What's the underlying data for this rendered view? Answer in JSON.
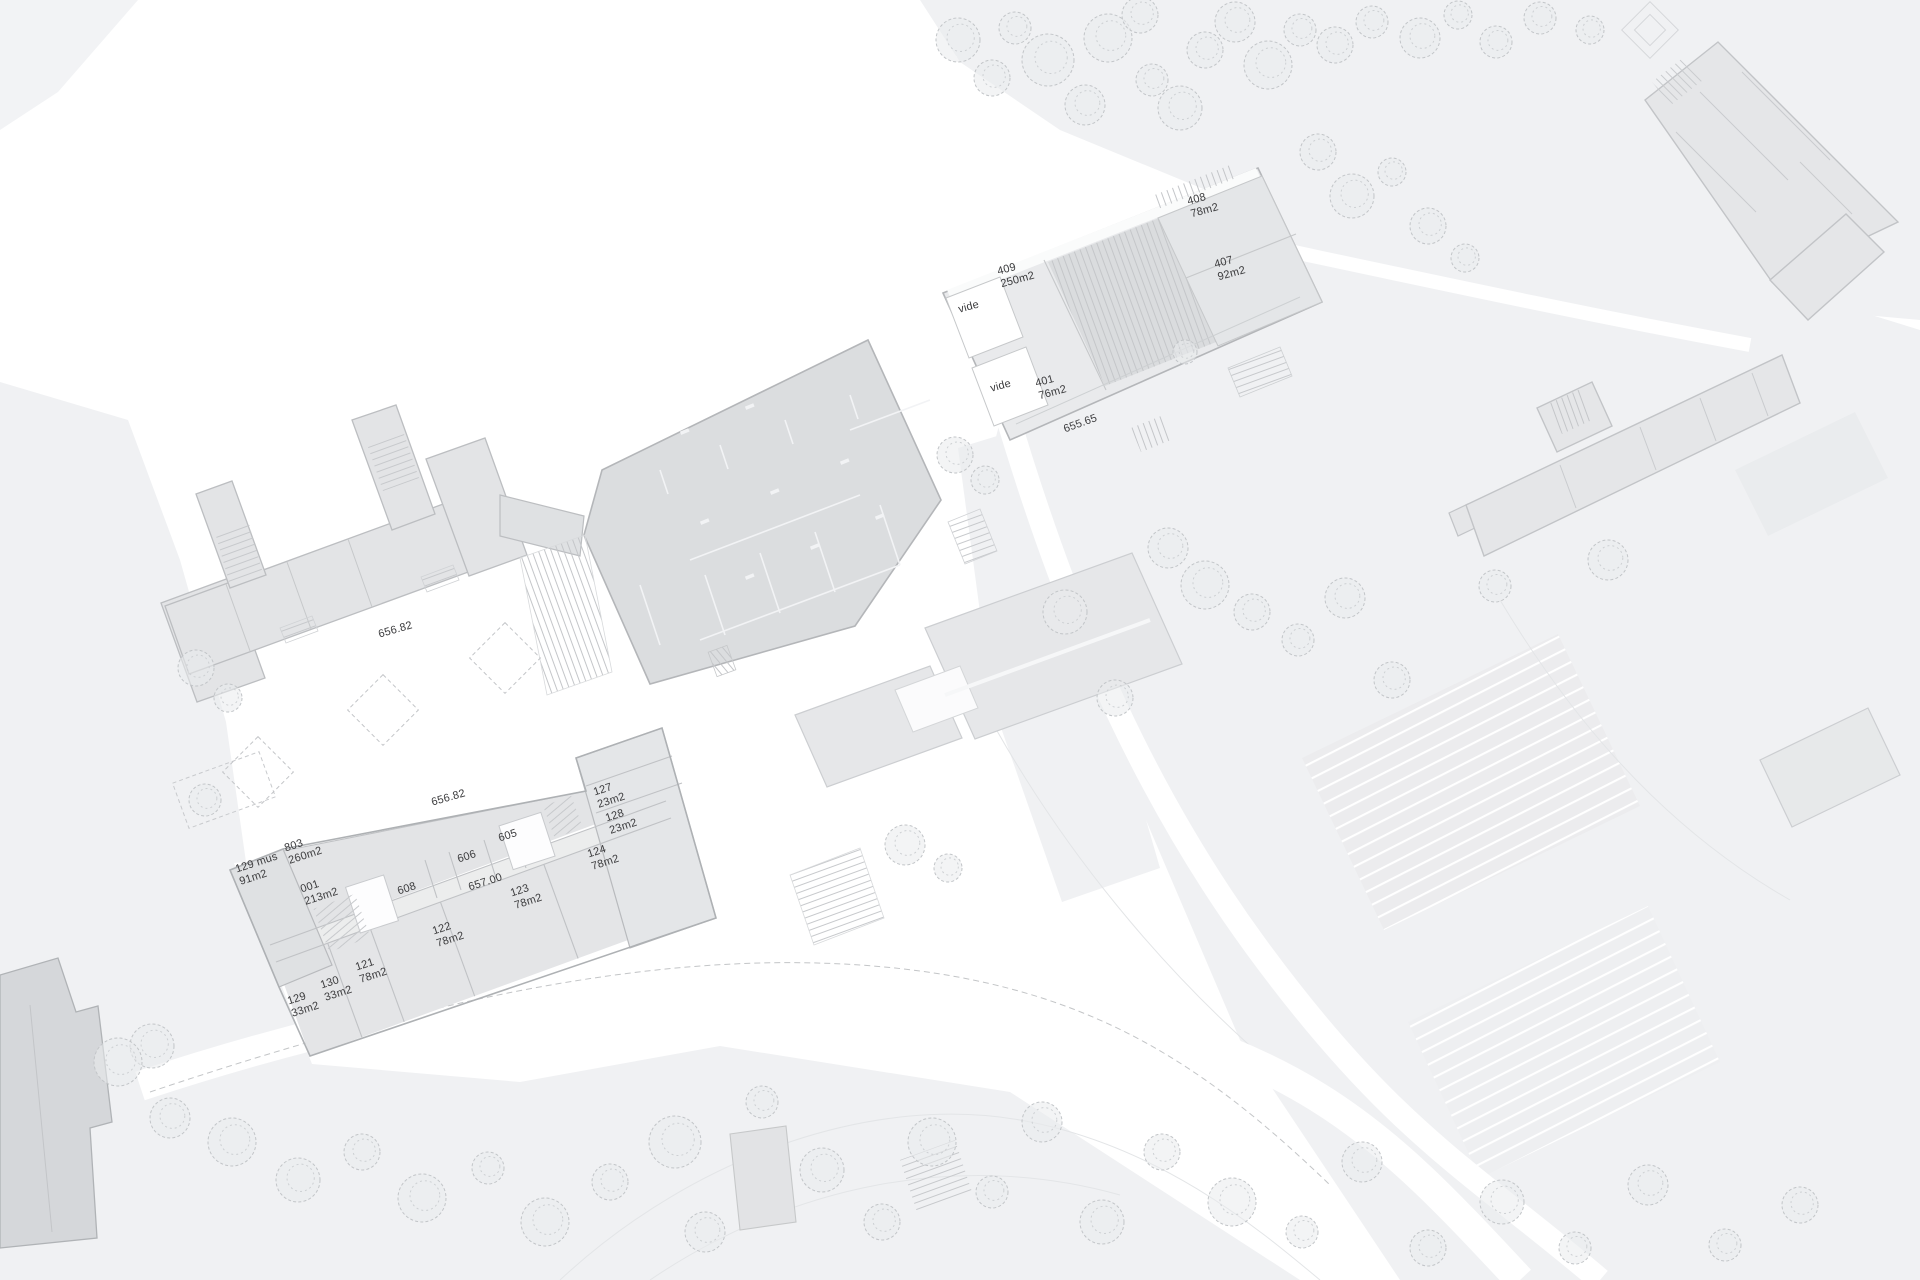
{
  "plan": {
    "type": "architectural site plan",
    "colors": {
      "paper": "#ffffff",
      "terrain": "#f0f1f3",
      "building_light": "#e5e6e8",
      "building_dark": "#dbdddf",
      "wall": "#b4b6b9",
      "hatch": "#c4c6c9",
      "text": "#3a3a3c"
    }
  },
  "rooms": [
    {
      "id": "409",
      "area": "250m2"
    },
    {
      "id": "408",
      "area": "78m2"
    },
    {
      "id": "407",
      "area": "92m2"
    },
    {
      "id": "401",
      "area": "76m2"
    },
    {
      "id": "803",
      "area": "260m2"
    },
    {
      "id": "129 mus",
      "area": "91m2"
    },
    {
      "id": "001",
      "area": "213m2"
    },
    {
      "id": "608"
    },
    {
      "id": "606"
    },
    {
      "id": "605"
    },
    {
      "id": "127",
      "area": "23m2"
    },
    {
      "id": "128",
      "area": "23m2"
    },
    {
      "id": "124",
      "area": "78m2"
    },
    {
      "id": "123",
      "area": "78m2"
    },
    {
      "id": "122",
      "area": "78m2"
    },
    {
      "id": "121",
      "area": "78m2"
    },
    {
      "id": "130",
      "area": "33m2"
    },
    {
      "id": "129",
      "area": "33m2"
    }
  ],
  "voids": [
    {
      "text": "vide"
    },
    {
      "text": "vide"
    }
  ],
  "levels": [
    {
      "value": "655.65"
    },
    {
      "value": "656.82"
    },
    {
      "value": "656.82"
    },
    {
      "value": "657.00"
    }
  ]
}
